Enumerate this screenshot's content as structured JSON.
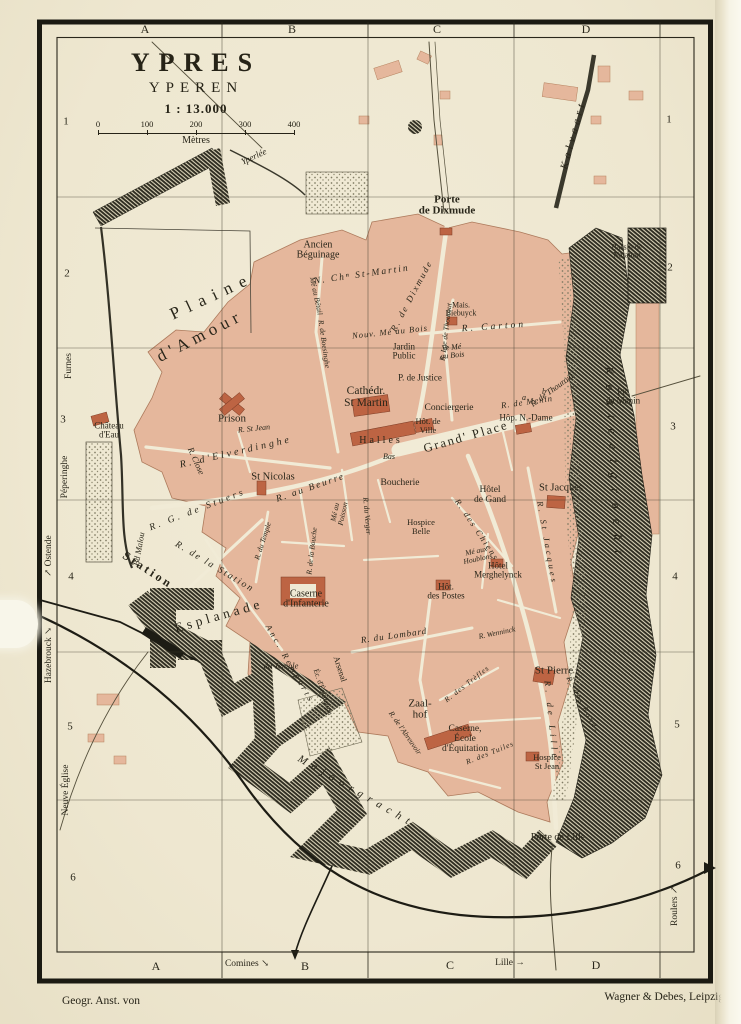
{
  "title": {
    "main": "YPRES",
    "sub": "YPEREN",
    "ratio": "1 : 13.000",
    "ticks": [
      "0",
      "100",
      "200",
      "300",
      "400"
    ],
    "unit": "Mètres"
  },
  "credits": {
    "left": "Geogr. Anst. von",
    "right": "Wagner & Debes, Leipzig."
  },
  "colors": {
    "paper": "#efe9d4",
    "block": "#e5b79c",
    "building": "#bd6443",
    "ink": "#262317",
    "water": "#2d2b20"
  },
  "frame_labels": [
    {
      "t": "A",
      "x": 145,
      "y": 29,
      "s": 12
    },
    {
      "t": "B",
      "x": 292,
      "y": 29,
      "s": 12
    },
    {
      "t": "C",
      "x": 437,
      "y": 29,
      "s": 12
    },
    {
      "t": "D",
      "x": 586,
      "y": 29,
      "s": 12
    },
    {
      "t": "A",
      "x": 156,
      "y": 966,
      "s": 12
    },
    {
      "t": "Comines ↘",
      "x": 247,
      "y": 965,
      "s": 9.5
    },
    {
      "t": "B",
      "x": 305,
      "y": 966,
      "s": 12
    },
    {
      "t": "C",
      "x": 450,
      "y": 965,
      "s": 12
    },
    {
      "t": "Lille →",
      "x": 510,
      "y": 964,
      "s": 9.5
    },
    {
      "t": "D",
      "x": 596,
      "y": 965,
      "s": 12
    },
    {
      "t": "1",
      "x": 66,
      "y": 122,
      "s": 11
    },
    {
      "t": "2",
      "x": 67,
      "y": 274,
      "s": 11
    },
    {
      "t": "3",
      "x": 63,
      "y": 420,
      "s": 11
    },
    {
      "t": "4",
      "x": 71,
      "y": 577,
      "s": 11
    },
    {
      "t": "5",
      "x": 70,
      "y": 727,
      "s": 11
    },
    {
      "t": "6",
      "x": 73,
      "y": 878,
      "s": 11
    },
    {
      "t": "1",
      "x": 669,
      "y": 120,
      "s": 11
    },
    {
      "t": "2",
      "x": 670,
      "y": 268,
      "s": 11
    },
    {
      "t": "3",
      "x": 673,
      "y": 427,
      "s": 11
    },
    {
      "t": "4",
      "x": 675,
      "y": 577,
      "s": 11
    },
    {
      "t": "5",
      "x": 677,
      "y": 725,
      "s": 11
    },
    {
      "t": "6",
      "x": 678,
      "y": 866,
      "s": 11
    }
  ],
  "map_labels": [
    {
      "t": "Porte\nde Dixmude",
      "x": 447,
      "y": 206,
      "s": 11,
      "b": 1
    },
    {
      "t": "Kalvaart",
      "x": 574,
      "y": 135,
      "r": -75,
      "s": 11,
      "i": 1,
      "sp": 4
    },
    {
      "t": "Bassin de\nNatation",
      "x": 627,
      "y": 252,
      "s": 8
    },
    {
      "t": "Yperlée",
      "x": 254,
      "y": 157,
      "r": -25,
      "s": 9,
      "i": 1
    },
    {
      "t": "Ancien\nBéguinage",
      "x": 318,
      "y": 251,
      "s": 10
    },
    {
      "t": "N. Chⁿ St-Martin",
      "x": 362,
      "y": 276,
      "r": -8,
      "s": 9.5,
      "i": 1,
      "sp": 2
    },
    {
      "t": "Plaine",
      "x": 212,
      "y": 296,
      "r": -25,
      "s": 17,
      "sp": 8
    },
    {
      "t": "d'Amour",
      "x": 200,
      "y": 336,
      "r": -27,
      "s": 17,
      "sp": 5
    },
    {
      "t": "R. de Dixmude",
      "x": 412,
      "y": 296,
      "r": -62,
      "s": 9,
      "i": 1,
      "sp": 2
    },
    {
      "t": "Mais.\nBiebuyck",
      "x": 461,
      "y": 310,
      "s": 8
    },
    {
      "t": "R. Carton",
      "x": 494,
      "y": 328,
      "r": -4,
      "s": 9.5,
      "i": 1,
      "sp": 3
    },
    {
      "t": "Nouv. Mé au Bois",
      "x": 390,
      "y": 332,
      "r": -6,
      "s": 8.5,
      "i": 1,
      "sp": 1
    },
    {
      "t": "Jardin\nPublic",
      "x": 404,
      "y": 352,
      "s": 9
    },
    {
      "t": "Ve Mé\nau Bois",
      "x": 452,
      "y": 352,
      "r": -6,
      "s": 8,
      "i": 1
    },
    {
      "t": "P. de Justice",
      "x": 420,
      "y": 378,
      "s": 9
    },
    {
      "t": "R. Lge de Thourout",
      "x": 446,
      "y": 332,
      "r": -83,
      "s": 7.5,
      "i": 1
    },
    {
      "t": "R. de Thourout",
      "x": 552,
      "y": 390,
      "r": -36,
      "s": 8.5,
      "i": 1
    },
    {
      "t": "Mé au Bétail",
      "x": 316,
      "y": 296,
      "r": 78,
      "s": 7.5,
      "i": 1
    },
    {
      "t": "R. de Boesinghe",
      "x": 324,
      "y": 344,
      "r": 82,
      "s": 7.5,
      "i": 1
    },
    {
      "t": "Prison",
      "x": 232,
      "y": 419,
      "s": 11
    },
    {
      "t": "Château\nd'Eau",
      "x": 109,
      "y": 431,
      "s": 9
    },
    {
      "t": "R. d'Elverdinghe",
      "x": 236,
      "y": 453,
      "r": -13,
      "s": 10,
      "i": 1,
      "sp": 3
    },
    {
      "t": "R. St Jean",
      "x": 254,
      "y": 429,
      "r": -6,
      "s": 8,
      "i": 1
    },
    {
      "t": "R. Close",
      "x": 196,
      "y": 461,
      "r": 66,
      "s": 8.5,
      "i": 1
    },
    {
      "t": "St Nicolas",
      "x": 273,
      "y": 478,
      "s": 10.5
    },
    {
      "t": "Cathédr.\nSt Martin",
      "x": 366,
      "y": 398,
      "s": 11.5
    },
    {
      "t": "Conciergerie",
      "x": 449,
      "y": 409,
      "s": 9.5
    },
    {
      "t": "Hôt. de\nVille",
      "x": 428,
      "y": 426,
      "s": 8.5
    },
    {
      "t": "Halles",
      "x": 381,
      "y": 441,
      "s": 10,
      "sp": 3
    },
    {
      "t": "Grand' Place",
      "x": 466,
      "y": 437,
      "r": -16,
      "s": 12.5,
      "sp": 2
    },
    {
      "t": "Bas",
      "x": 389,
      "y": 457,
      "s": 8,
      "i": 1
    },
    {
      "t": "R. de Menin",
      "x": 527,
      "y": 402,
      "r": -8,
      "s": 8.5,
      "i": 1,
      "sp": 1
    },
    {
      "t": "Hôp. N.-Dame",
      "x": 526,
      "y": 418,
      "s": 9
    },
    {
      "t": "Pte\nde Menin",
      "x": 623,
      "y": 397,
      "s": 9
    },
    {
      "t": "a",
      "x": 524,
      "y": 398,
      "s": 8,
      "i": 1
    },
    {
      "t": "b",
      "x": 544,
      "y": 392,
      "s": 8,
      "i": 1
    },
    {
      "t": "Boucherie",
      "x": 400,
      "y": 484,
      "s": 9.5
    },
    {
      "t": "Hôtel\nde Gand",
      "x": 490,
      "y": 496,
      "s": 9.5
    },
    {
      "t": "St Jacques",
      "x": 561,
      "y": 489,
      "s": 10.5
    },
    {
      "t": "R. St Jacques",
      "x": 547,
      "y": 543,
      "r": 80,
      "s": 8.5,
      "i": 1,
      "sp": 3
    },
    {
      "t": "R. des Chiens",
      "x": 477,
      "y": 530,
      "r": 56,
      "s": 8.5,
      "i": 1,
      "sp": 2
    },
    {
      "t": "Mé aux\nHoublons",
      "x": 477,
      "y": 555,
      "r": -12,
      "s": 7.5,
      "i": 1
    },
    {
      "t": "Hôtel\nMerghelynck",
      "x": 498,
      "y": 571,
      "s": 9
    },
    {
      "t": "Hospice\nBelle",
      "x": 421,
      "y": 527,
      "s": 8.5
    },
    {
      "t": "Hôt.\ndes Postes",
      "x": 446,
      "y": 592,
      "s": 9
    },
    {
      "t": "R. G. de Stuers",
      "x": 198,
      "y": 511,
      "r": -21,
      "s": 9.5,
      "i": 1,
      "sp": 3
    },
    {
      "t": "R. au Beurre",
      "x": 311,
      "y": 489,
      "r": -19,
      "s": 9.5,
      "i": 1,
      "sp": 2
    },
    {
      "t": "Mé au\nPoisson",
      "x": 339,
      "y": 513,
      "r": -78,
      "s": 7.5,
      "i": 1
    },
    {
      "t": "R. de la Bouche",
      "x": 312,
      "y": 551,
      "r": -83,
      "s": 7.5,
      "i": 1
    },
    {
      "t": "R. de la Station",
      "x": 214,
      "y": 568,
      "r": 31,
      "s": 9.5,
      "i": 1,
      "sp": 2
    },
    {
      "t": "R. du Temple",
      "x": 263,
      "y": 541,
      "r": -72,
      "s": 7.5,
      "i": 1
    },
    {
      "t": "Bd Malou",
      "x": 139,
      "y": 549,
      "r": -80,
      "s": 8.5,
      "i": 1
    },
    {
      "t": "R. du Verger",
      "x": 367,
      "y": 516,
      "r": 85,
      "s": 7.5,
      "i": 1
    },
    {
      "t": "R. Wenninck",
      "x": 497,
      "y": 633,
      "r": -12,
      "s": 7.5,
      "i": 1
    },
    {
      "t": "Esplanade",
      "x": 219,
      "y": 616,
      "r": -16,
      "s": 13.5,
      "sp": 4
    },
    {
      "t": "Caserne\nd'Infanterie",
      "x": 306,
      "y": 600,
      "s": 10
    },
    {
      "t": "R. du Lombard",
      "x": 394,
      "y": 636,
      "r": -8,
      "s": 9,
      "i": 1,
      "sp": 1
    },
    {
      "t": "Anc. Remparts",
      "x": 290,
      "y": 664,
      "r": 60,
      "s": 8.5,
      "i": 1,
      "sp": 3
    },
    {
      "t": "Arsenal",
      "x": 340,
      "y": 669,
      "r": 72,
      "s": 8.5
    },
    {
      "t": "Éc. d'Équitation",
      "x": 323,
      "y": 692,
      "r": 72,
      "s": 7.5
    },
    {
      "t": "du Temple",
      "x": 281,
      "y": 666,
      "s": 8.5,
      "i": 1
    },
    {
      "t": "Zaal-\nhof",
      "x": 420,
      "y": 710,
      "s": 11
    },
    {
      "t": "R. de l'Abreuvoir",
      "x": 405,
      "y": 733,
      "r": 55,
      "s": 7.5,
      "i": 1
    },
    {
      "t": "R. des Trèfles",
      "x": 467,
      "y": 684,
      "r": -38,
      "s": 7.5,
      "i": 1,
      "sp": 1
    },
    {
      "t": "St Pierre",
      "x": 554,
      "y": 671,
      "s": 11
    },
    {
      "t": "R. de Lille",
      "x": 551,
      "y": 721,
      "r": 84,
      "s": 9,
      "i": 1,
      "sp": 4
    },
    {
      "t": "R. des Ronds",
      "x": 583,
      "y": 705,
      "r": 62,
      "s": 7.5,
      "i": 1,
      "sp": 2
    },
    {
      "t": "R. des Tuiles",
      "x": 490,
      "y": 753,
      "r": -22,
      "s": 7.5,
      "i": 1,
      "sp": 1
    },
    {
      "t": "Caserne,\nÉcole\nd'Équitation",
      "x": 465,
      "y": 740,
      "s": 9.5
    },
    {
      "t": "Hospice\nSt Jean",
      "x": 547,
      "y": 762,
      "s": 8.5
    },
    {
      "t": "Porte de Lille",
      "x": 558,
      "y": 838,
      "s": 10
    },
    {
      "t": "Majoorgracht",
      "x": 356,
      "y": 792,
      "r": 30,
      "s": 11,
      "i": 1,
      "sp": 6
    },
    {
      "t": "Kasteelgracht",
      "x": 614,
      "y": 465,
      "r": 87,
      "s": 12,
      "i": 1,
      "sp": 10
    },
    {
      "t": "Furnes",
      "x": 70,
      "y": 366,
      "r": -90,
      "s": 9.5
    },
    {
      "t": "Péperinghe",
      "x": 66,
      "y": 477,
      "r": -90,
      "s": 9.5
    },
    {
      "t": "↗ Ostende",
      "x": 50,
      "y": 556,
      "r": -90,
      "s": 9.5
    },
    {
      "t": "Hazebrouck ↘",
      "x": 50,
      "y": 655,
      "r": -90,
      "s": 9.5
    },
    {
      "t": "Station",
      "x": 148,
      "y": 570,
      "r": 33,
      "s": 12,
      "sp": 3,
      "b": 1
    },
    {
      "t": "Neuve Église",
      "x": 67,
      "y": 790,
      "r": -90,
      "s": 9.5
    },
    {
      "t": "Roulers ↗",
      "x": 676,
      "y": 906,
      "r": -90,
      "s": 9.5
    }
  ]
}
